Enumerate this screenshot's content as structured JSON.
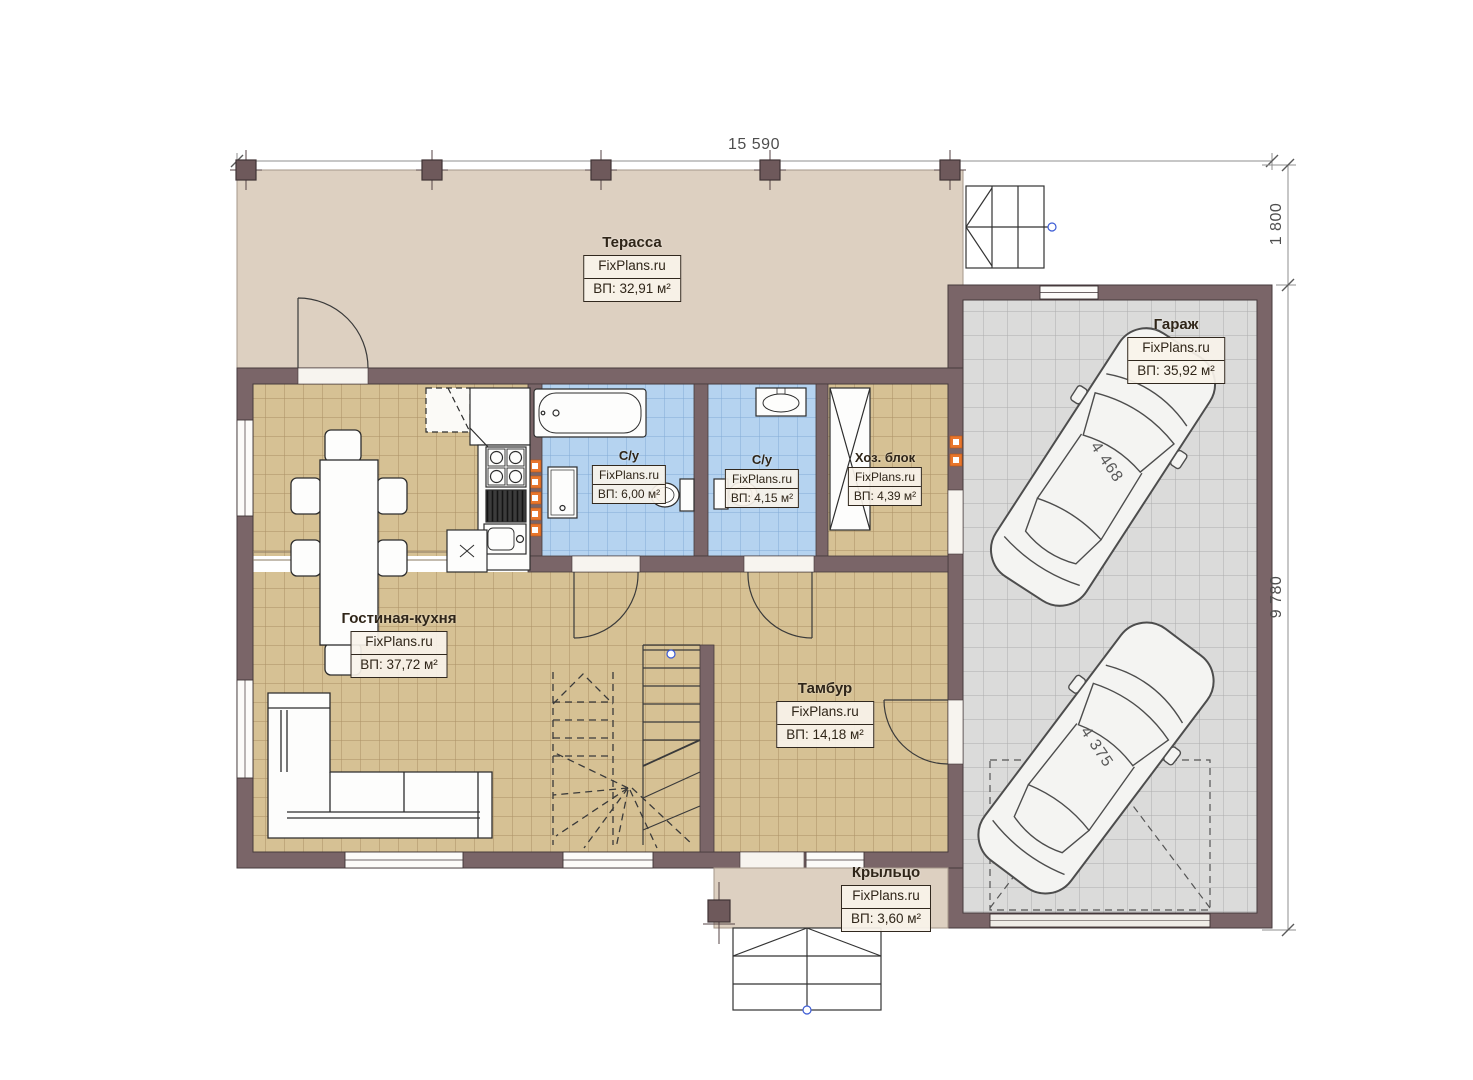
{
  "plan": {
    "dimensions": {
      "width_total": "15 590",
      "terrace_depth": "1 800",
      "house_depth": "9 780"
    },
    "rooms": [
      {
        "name": "Терасса",
        "brand": "FixPlans.ru",
        "area": "ВП: 32,91 м²"
      },
      {
        "name": "Гараж",
        "brand": "FixPlans.ru",
        "area": "ВП: 35,92 м²"
      },
      {
        "name": "С/у",
        "brand": "FixPlans.ru",
        "area": "ВП: 6,00 м²"
      },
      {
        "name": "С/у",
        "brand": "FixPlans.ru",
        "area": "ВП: 4,15 м²"
      },
      {
        "name": "Хоз. блок",
        "brand": "FixPlans.ru",
        "area": "ВП: 4,39 м²"
      },
      {
        "name": "Гостиная-кухня",
        "brand": "FixPlans.ru",
        "area": "ВП: 37,72 м²"
      },
      {
        "name": "Тамбур",
        "brand": "FixPlans.ru",
        "area": "ВП: 14,18 м²"
      },
      {
        "name": "Крыльцо",
        "brand": "FixPlans.ru",
        "area": "ВП: 3,60 м²"
      }
    ],
    "cars": [
      {
        "length": "4 468"
      },
      {
        "length": "4 375"
      }
    ],
    "colors": {
      "wall": "#7a6568",
      "floor_tan": "#d6c194",
      "floor_blue": "#b5d3f0",
      "floor_gray": "#dbdbda",
      "terrace_beige": "#ddd0c1",
      "accent_orange": "#e8762c"
    }
  }
}
